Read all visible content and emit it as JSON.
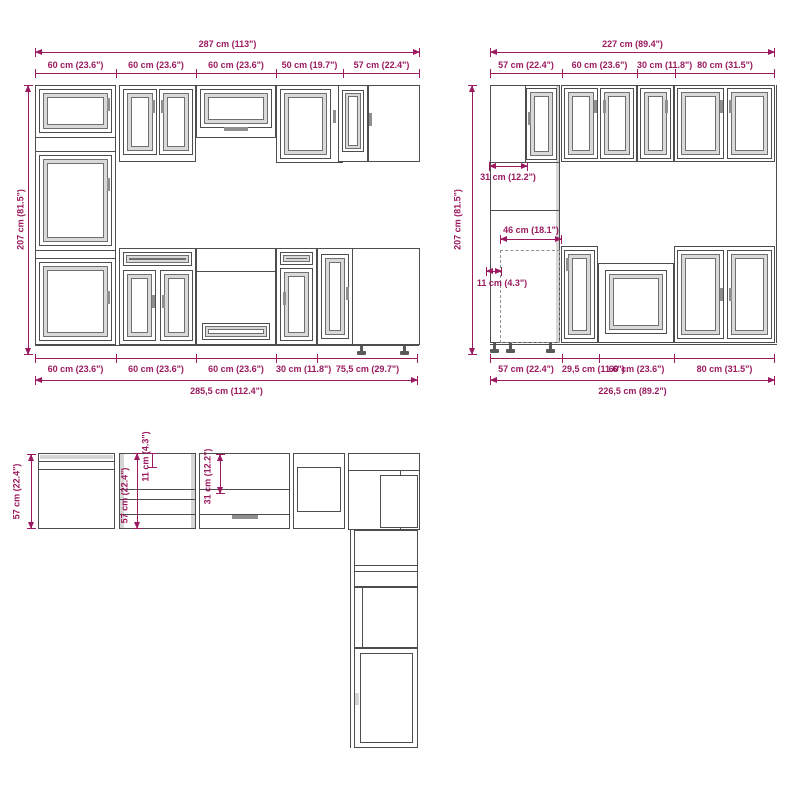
{
  "drawing_type": "kitchen-cabinet-set-dimension-diagram",
  "colors": {
    "dimension_accent": "#9b1a5f",
    "line": "#4d4d4d",
    "panel_gray": "#d9d9d9"
  },
  "front_left": {
    "total_top": "287 cm (113\")",
    "seg_top": [
      "60 cm (23.6\")",
      "60 cm (23.6\")",
      "60 cm (23.6\")",
      "50 cm (19.7\")",
      "57 cm (22.4\")"
    ],
    "height": "207 cm (81.5\")",
    "seg_bottom": [
      "60 cm (23.6\")",
      "60 cm (23.6\")",
      "60 cm (23.6\")",
      "30 cm (11.8\")",
      "75,5 cm (29.7\")"
    ],
    "total_bottom": "285,5 cm (112.4\")"
  },
  "front_right": {
    "total_top": "227 cm (89.4\")",
    "seg_top": [
      "57 cm (22.4\")",
      "60 cm (23.6\")",
      "30 cm (11.8\")",
      "80 cm (31.5\")"
    ],
    "height": "207 cm (81.5\")",
    "dim_31": "31 cm (12.2\")",
    "dim_46": "46 cm (18.1\")",
    "dim_11": "11 cm (4.3\")",
    "seg_bottom": [
      "57 cm (22.4\")",
      "29,5 cm (11.6\")",
      "60 cm (23.6\")",
      "80 cm (31.5\")"
    ],
    "total_bottom": "226,5 cm (89.2\")"
  },
  "plan": {
    "depth_left": "57 cm (22.4\")",
    "depth_inner": "57 cm (22.4\")",
    "dim_11": "11 cm (4.3\")",
    "dim_31": "31 cm (12.2\")"
  }
}
